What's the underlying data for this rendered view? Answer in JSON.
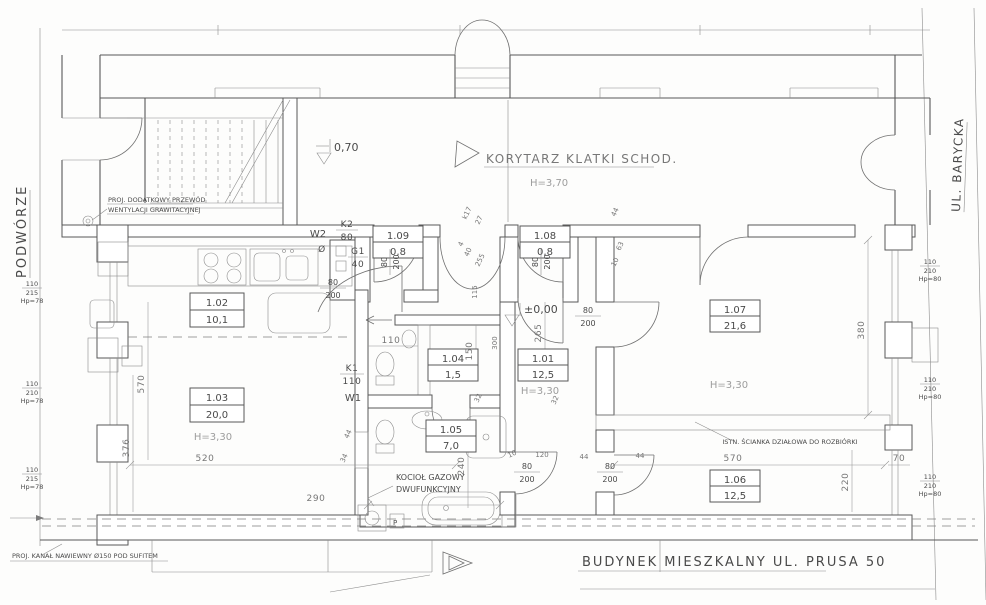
{
  "streets": {
    "left": "PODWÓRZE",
    "right": "UL. BARYCKA"
  },
  "corridor": {
    "name": "KORYTARZ KLATKI SCHOD.",
    "height": "H=3,70",
    "level": "0,70"
  },
  "apartment": {
    "level": "±0,00"
  },
  "title_block": {
    "building": "BUDYNEK MIESZKALNY  UL. PRUSA 50"
  },
  "annotations": {
    "vent_flue_1": "PROJ. DODATKOWY PRZEWÓD",
    "vent_flue_2": "WENTYLACJI GRAWITACYJNEJ",
    "supply_duct": "PROJ. KANAŁ NAWIEWNY  Ø150 POD SUFITEM",
    "demolition_wall": "ISTN. ŚCIANKA DZIAŁOWA DO ROZBIÓRKI",
    "boiler_1": "KOCIOŁ GAZOWY",
    "boiler_2": "DWUFUNKCYJNY",
    "washer": "P"
  },
  "rooms": {
    "r101": {
      "no": "1.01",
      "area": "12,5",
      "h": "H=3,30"
    },
    "r102": {
      "no": "1.02",
      "area": "10,1"
    },
    "r103": {
      "no": "1.03",
      "area": "20,0",
      "h": "H=3,30"
    },
    "r104": {
      "no": "1.04",
      "area": "1,5"
    },
    "r105": {
      "no": "1.05",
      "area": "7,0"
    },
    "r106": {
      "no": "1.06",
      "area": "12,5"
    },
    "r107": {
      "no": "1.07",
      "area": "21,6",
      "h": "H=3,30"
    },
    "r108": {
      "no": "1.08",
      "area": "0,8"
    },
    "r109": {
      "no": "1.09",
      "area": "0,8"
    }
  },
  "stacks": {
    "w2": "W2",
    "w2d": "Ø",
    "k2": "K2",
    "k2s": "80",
    "g1": "G1",
    "g1s": "40",
    "k1": "K1",
    "k1s": "110",
    "w1": "W1"
  },
  "door": {
    "w": "80",
    "h": "200"
  },
  "windows": {
    "l1a": "110",
    "l1b": "215",
    "l1c": "Hp=78",
    "l2a": "110",
    "l2b": "210",
    "l2c": "Hp=78",
    "l3a": "110",
    "l3b": "215",
    "l3c": "Hp=78",
    "ra": "110",
    "rb": "210",
    "rc": "Hp=80"
  },
  "dims": {
    "d520": "520",
    "d570": "570",
    "d376": "376",
    "d380": "380",
    "d290": "290",
    "d240": "240",
    "d265": "265",
    "d220": "220",
    "d150": "150",
    "d115": "115",
    "d110": "110",
    "d300": "300",
    "d255": "255",
    "d120": "120",
    "d70": "70",
    "d63": "63",
    "d44": "44",
    "d40": "40",
    "d34": "34",
    "d32": "32",
    "d27": "27",
    "d10": "10",
    "d4": "4",
    "k17": "k17"
  }
}
